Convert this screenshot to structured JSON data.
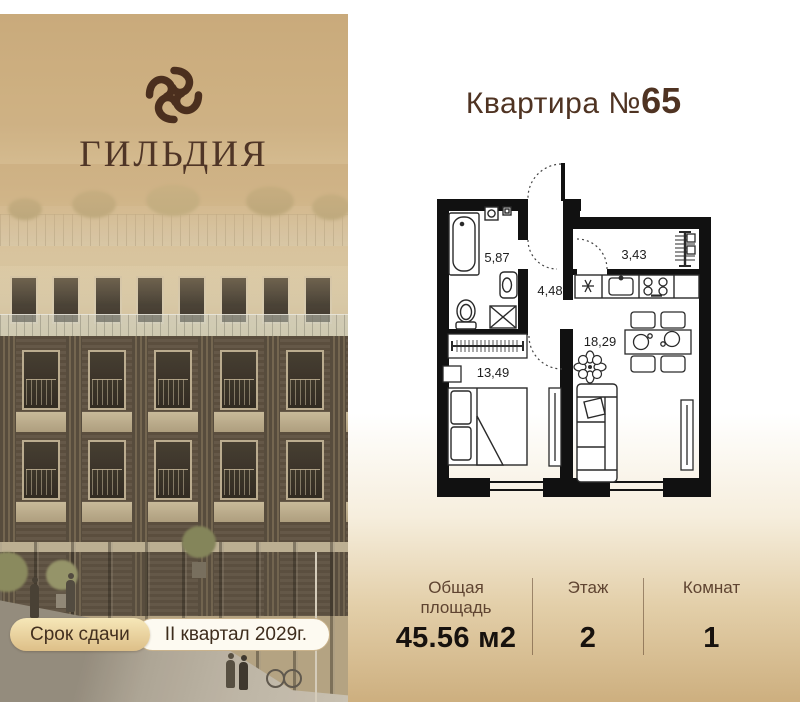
{
  "brand": {
    "name": "ГИЛЬДИЯ",
    "icon": "knot-logo-icon"
  },
  "badge": {
    "label": "Срок сдачи",
    "value": "II квартал 2029г."
  },
  "apartment": {
    "title_prefix": "Квартира №",
    "title_number": "65"
  },
  "floor_plan": {
    "areas": {
      "bathroom": "5,87",
      "hall": "3,43",
      "corridor": "4,48",
      "kitchen_living": "18,29",
      "bedroom": "13,49"
    }
  },
  "details": {
    "items": [
      {
        "label": "Общая площадь",
        "value": "45.56 м2"
      },
      {
        "label": "Этаж",
        "value": "2"
      },
      {
        "label": "Комнат",
        "value": "1"
      }
    ]
  },
  "colors": {
    "accent_tan": "#cbad80",
    "text_brown": "#4f3322",
    "badge_gold": "#e8cd96",
    "plan_line": "#111111"
  }
}
